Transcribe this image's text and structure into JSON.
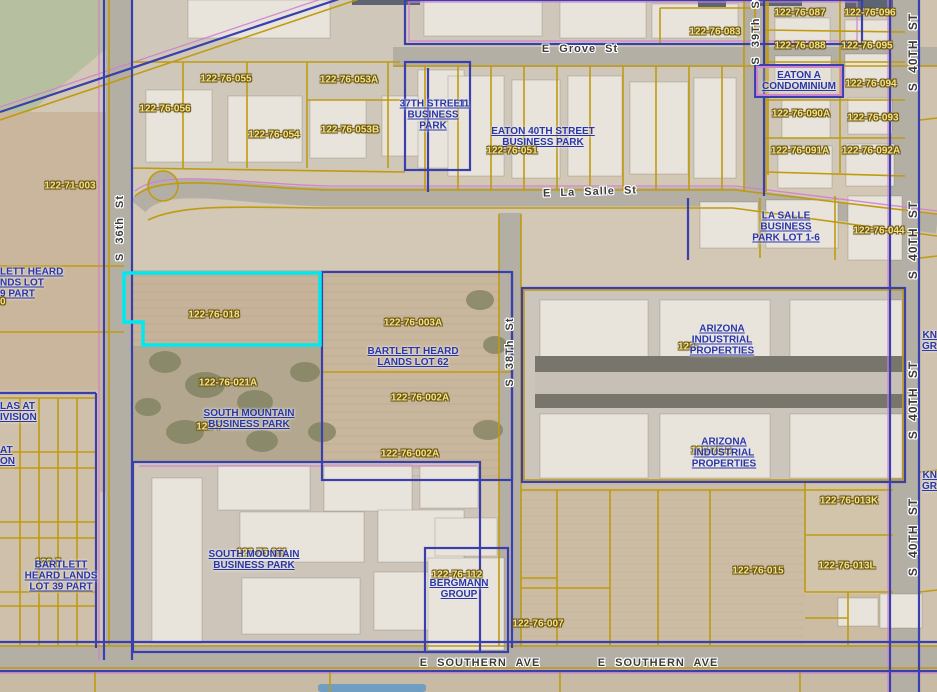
{
  "map": {
    "type": "aerial-parcel-map",
    "selected_parcel": {
      "id": "122-76-018",
      "highlight_color": "#00e8f0"
    },
    "colors": {
      "parcel_line": "#bf9b10",
      "subdivision_line": "#3a3fae",
      "overlay_line_pink": "#cf7fd2",
      "parcel_label_text": "#f2e389",
      "subdivision_label_text": "#2a35a8",
      "street_label_text": "#3b3b3b",
      "highlight": "#00e8f0"
    }
  },
  "parcel_labels": [
    {
      "text": "122-71-003"
    },
    {
      "text": "122-76-056"
    },
    {
      "text": "122-76-055"
    },
    {
      "text": "122-76-054"
    },
    {
      "text": "122-76-053A"
    },
    {
      "text": "122-76-053B"
    },
    {
      "text": "122-76-051"
    },
    {
      "text": "122-76-083"
    },
    {
      "text": "122-76-087"
    },
    {
      "text": "122-76-096"
    },
    {
      "text": "122-76-088"
    },
    {
      "text": "122-76-095"
    },
    {
      "text": "122-76-094"
    },
    {
      "text": "122-76-090A"
    },
    {
      "text": "122-76-093"
    },
    {
      "text": "122-76-091A"
    },
    {
      "text": "122-76-092A"
    },
    {
      "text": "122-76-044"
    },
    {
      "text": "122-76-018"
    },
    {
      "text": "122-76-003A"
    },
    {
      "text": "122-76-021A"
    },
    {
      "text": "122-76-002A"
    },
    {
      "text": "122-76-002A"
    },
    {
      "text": "122-76-013K"
    },
    {
      "text": "122-76-015"
    },
    {
      "text": "122-76-013L"
    },
    {
      "text": "122-76-007"
    },
    {
      "text": "122-"
    },
    {
      "text": "122-76-0"
    },
    {
      "text": "122-7"
    },
    {
      "text": "122-76-011"
    },
    {
      "text": "122-76-112"
    },
    {
      "text": "122-7"
    },
    {
      "text": "0"
    }
  ],
  "subdivision_labels": [
    {
      "lines": [
        "37TH STREET",
        "BUSINESS",
        "PARK"
      ]
    },
    {
      "lines": [
        "11"
      ]
    },
    {
      "lines": [
        "EATON 40TH STREET",
        "BUSINESS PARK"
      ]
    },
    {
      "lines": [
        "EATON A",
        "CONDOMINIUM"
      ]
    },
    {
      "lines": [
        "LA SALLE",
        "BUSINESS",
        "PARK LOT 1-6"
      ]
    },
    {
      "lines": [
        "BARTLETT HEARD",
        "LANDS LOT 62"
      ]
    },
    {
      "lines": [
        "SOUTH MOUNTAIN",
        "BUSINESS PARK"
      ]
    },
    {
      "lines": [
        "ARIZONA",
        "INDUSTRIAL",
        "PROPERTIES"
      ]
    },
    {
      "lines": [
        "ARIZONA",
        "INDUSTRIAL",
        "PROPERTIES"
      ]
    },
    {
      "lines": [
        "SOUTH MOUNTAIN",
        "BUSINESS PARK"
      ]
    },
    {
      "lines": [
        "BERGMANN",
        "GROUP"
      ]
    },
    {
      "lines": [
        "BARTLETT",
        "HEARD LANDS",
        "LOT 39 PART"
      ]
    },
    {
      "lines": [
        "LETT HEARD",
        "NDS LOT",
        "9 PART"
      ]
    },
    {
      "lines": [
        "LAS AT",
        "IVISION"
      ]
    },
    {
      "lines": [
        "AT",
        "ON"
      ]
    },
    {
      "lines": [
        "KN",
        "GR"
      ]
    },
    {
      "lines": [
        "KN",
        "GR"
      ]
    }
  ],
  "street_labels": [
    {
      "text": "E Grove St"
    },
    {
      "text": "E La Salle St"
    },
    {
      "text": "E SOUTHERN AVE"
    },
    {
      "text": "E SOUTHERN AVE"
    },
    {
      "text": "S 36th St"
    },
    {
      "text": "S 38Th St"
    },
    {
      "text": "S 39Th St"
    },
    {
      "text": "S 40TH ST"
    },
    {
      "text": "S 40TH ST"
    },
    {
      "text": "S 40TH ST"
    },
    {
      "text": "S 40TH ST"
    }
  ]
}
